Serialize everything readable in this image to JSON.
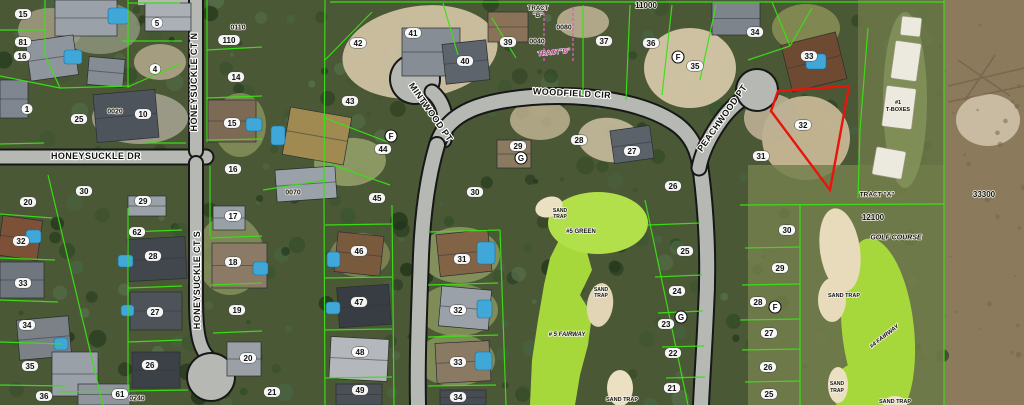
{
  "map": {
    "title": "Aerial parcel map - Woodfield Cir / Honeysuckle Dr subdivision with golf course",
    "colors": {
      "parcel_line": "#3ae114",
      "highlight_parcel": "#e8150d",
      "road_fill": "#b5b8b3",
      "road_casing": "#171717",
      "fairway_green": "#a6d83c",
      "sand_trap": "#ece0c2",
      "tract_b_magenta": "#e05cc0",
      "label_halo": "#ffffff"
    },
    "highlighted_parcel": {
      "lot": "32",
      "outline_color": "#e8150d"
    },
    "streets": [
      {
        "id": "honeysuckle-dr",
        "name": "HONEYSUCKLE DR",
        "x": 96,
        "y": 156,
        "rot": 0
      },
      {
        "id": "honeysuckle-ct-n",
        "name": "HONEYSUCKLE CT N",
        "x": 194,
        "y": 82,
        "rot": -90
      },
      {
        "id": "honeysuckle-ct-s",
        "name": "HONEYSUCKLE CT S",
        "x": 197,
        "y": 280,
        "rot": -90
      },
      {
        "id": "woodfield-cir",
        "name": "WOODFIELD CIR",
        "x": 572,
        "y": 93,
        "rot": 3
      },
      {
        "id": "mintwood-pt",
        "name": "MINTWOOD PT",
        "x": 431,
        "y": 112,
        "rot": 55
      },
      {
        "id": "peachwood-pt",
        "name": "PEACHWOOD PT",
        "x": 722,
        "y": 118,
        "rot": -55
      }
    ],
    "lots": [
      {
        "n": "15",
        "x": 23,
        "y": 14
      },
      {
        "n": "81",
        "x": 23,
        "y": 42
      },
      {
        "n": "16",
        "x": 22,
        "y": 56
      },
      {
        "n": "5",
        "x": 157,
        "y": 23
      },
      {
        "n": "4",
        "x": 155,
        "y": 69
      },
      {
        "n": "14",
        "x": 236,
        "y": 77
      },
      {
        "n": "15",
        "x": 232,
        "y": 123
      },
      {
        "n": "1",
        "x": 27,
        "y": 109
      },
      {
        "n": "25",
        "x": 79,
        "y": 119
      },
      {
        "n": "10",
        "x": 143,
        "y": 114
      },
      {
        "n": "16",
        "x": 233,
        "y": 169
      },
      {
        "n": "30",
        "x": 84,
        "y": 191
      },
      {
        "n": "29",
        "x": 143,
        "y": 201
      },
      {
        "n": "20",
        "x": 28,
        "y": 202
      },
      {
        "n": "32",
        "x": 21,
        "y": 241
      },
      {
        "n": "33",
        "x": 23,
        "y": 283
      },
      {
        "n": "34",
        "x": 27,
        "y": 325
      },
      {
        "n": "35",
        "x": 30,
        "y": 366
      },
      {
        "n": "36",
        "x": 44,
        "y": 396
      },
      {
        "n": "62",
        "x": 137,
        "y": 232
      },
      {
        "n": "28",
        "x": 153,
        "y": 256
      },
      {
        "n": "27",
        "x": 155,
        "y": 312
      },
      {
        "n": "26",
        "x": 150,
        "y": 365
      },
      {
        "n": "17",
        "x": 233,
        "y": 216
      },
      {
        "n": "18",
        "x": 233,
        "y": 262
      },
      {
        "n": "19",
        "x": 237,
        "y": 310
      },
      {
        "n": "20",
        "x": 248,
        "y": 358
      },
      {
        "n": "61",
        "x": 120,
        "y": 394
      },
      {
        "n": "110",
        "x": 229,
        "y": 40
      },
      {
        "n": "42",
        "x": 358,
        "y": 43
      },
      {
        "n": "41",
        "x": 413,
        "y": 33
      },
      {
        "n": "40",
        "x": 465,
        "y": 61
      },
      {
        "n": "39",
        "x": 508,
        "y": 42
      },
      {
        "n": "43",
        "x": 350,
        "y": 101
      },
      {
        "n": "44",
        "x": 383,
        "y": 149
      },
      {
        "n": "45",
        "x": 377,
        "y": 198
      },
      {
        "n": "30",
        "x": 475,
        "y": 192
      },
      {
        "n": "37",
        "x": 604,
        "y": 41
      },
      {
        "n": "36",
        "x": 651,
        "y": 43
      },
      {
        "n": "35",
        "x": 695,
        "y": 66
      },
      {
        "n": "34",
        "x": 755,
        "y": 32
      },
      {
        "n": "33",
        "x": 809,
        "y": 56
      },
      {
        "n": "32",
        "x": 803,
        "y": 125
      },
      {
        "n": "31",
        "x": 761,
        "y": 156
      },
      {
        "n": "29",
        "x": 518,
        "y": 146
      },
      {
        "n": "28",
        "x": 579,
        "y": 140
      },
      {
        "n": "27",
        "x": 632,
        "y": 151
      },
      {
        "n": "26",
        "x": 673,
        "y": 186
      },
      {
        "n": "46",
        "x": 359,
        "y": 251
      },
      {
        "n": "47",
        "x": 359,
        "y": 302
      },
      {
        "n": "48",
        "x": 360,
        "y": 352
      },
      {
        "n": "49",
        "x": 360,
        "y": 390
      },
      {
        "n": "21",
        "x": 272,
        "y": 392
      },
      {
        "n": "31",
        "x": 462,
        "y": 259
      },
      {
        "n": "32",
        "x": 458,
        "y": 310
      },
      {
        "n": "33",
        "x": 458,
        "y": 362
      },
      {
        "n": "34",
        "x": 458,
        "y": 397
      },
      {
        "n": "25",
        "x": 685,
        "y": 251
      },
      {
        "n": "24",
        "x": 677,
        "y": 291
      },
      {
        "n": "23",
        "x": 666,
        "y": 324
      },
      {
        "n": "22",
        "x": 673,
        "y": 353
      },
      {
        "n": "21",
        "x": 672,
        "y": 388
      },
      {
        "n": "30",
        "x": 787,
        "y": 230
      },
      {
        "n": "29",
        "x": 780,
        "y": 268
      },
      {
        "n": "28",
        "x": 758,
        "y": 302
      },
      {
        "n": "27",
        "x": 769,
        "y": 333
      },
      {
        "n": "26",
        "x": 768,
        "y": 367
      },
      {
        "n": "25",
        "x": 769,
        "y": 394
      }
    ],
    "rings": [
      {
        "n": "F",
        "x": 391,
        "y": 136
      },
      {
        "n": "F",
        "x": 678,
        "y": 57
      },
      {
        "n": "G",
        "x": 521,
        "y": 158
      },
      {
        "n": "G",
        "x": 681,
        "y": 317
      },
      {
        "n": "F",
        "x": 775,
        "y": 307
      }
    ],
    "areas": [
      {
        "t": "11000",
        "x": 646,
        "y": 5,
        "s": 8
      },
      {
        "t": "33300",
        "x": 984,
        "y": 194,
        "s": 8
      },
      {
        "t": "12100",
        "x": 873,
        "y": 217,
        "s": 8
      },
      {
        "t": "GOLF COURSE",
        "x": 896,
        "y": 237,
        "s": 7,
        "i": 1
      },
      {
        "t": "TRACT",
        "x": 538,
        "y": 8,
        "s": 6
      },
      {
        "t": "\"B\"",
        "x": 538,
        "y": 15,
        "s": 6
      },
      {
        "t": "0080",
        "x": 564,
        "y": 27,
        "s": 7
      },
      {
        "t": "0040",
        "x": 537,
        "y": 41,
        "s": 7
      },
      {
        "t": "TRACT \"A\"",
        "x": 877,
        "y": 194,
        "s": 6.5
      },
      {
        "t": "0110",
        "x": 238,
        "y": 27,
        "s": 7
      },
      {
        "t": "0020",
        "x": 115,
        "y": 111,
        "s": 7
      },
      {
        "t": "0070",
        "x": 293,
        "y": 192,
        "s": 7
      },
      {
        "t": "0240",
        "x": 137,
        "y": 398,
        "s": 7
      },
      {
        "t": "#1",
        "x": 898,
        "y": 102,
        "s": 5.5
      },
      {
        "t": "T-BOXES",
        "x": 898,
        "y": 109,
        "s": 5.5
      },
      {
        "t": "SAND",
        "x": 560,
        "y": 210,
        "s": 5
      },
      {
        "t": "TRAP",
        "x": 560,
        "y": 216,
        "s": 5
      },
      {
        "t": "#5 GREEN",
        "x": 581,
        "y": 231,
        "s": 6
      },
      {
        "t": "SAND",
        "x": 601,
        "y": 289,
        "s": 5
      },
      {
        "t": "TRAP",
        "x": 601,
        "y": 295,
        "s": 5
      },
      {
        "t": "# 5 FAIRWAY",
        "x": 567,
        "y": 334,
        "s": 6,
        "i": 1
      },
      {
        "t": "SAND TRAP",
        "x": 622,
        "y": 399,
        "s": 5.5
      },
      {
        "t": "SAND TRAP",
        "x": 844,
        "y": 295,
        "s": 5.5
      },
      {
        "t": "#4 FAIRWAY",
        "x": 884,
        "y": 336,
        "s": 6,
        "i": 1,
        "rot": -38
      },
      {
        "t": "SAND",
        "x": 837,
        "y": 383,
        "s": 5
      },
      {
        "t": "TRAP",
        "x": 837,
        "y": 390,
        "s": 5
      },
      {
        "t": "SAND TRAP",
        "x": 895,
        "y": 401,
        "s": 5.5
      }
    ],
    "magenta_labels": [
      {
        "t": "TRACT\"B\"",
        "x": 554,
        "y": 52,
        "rot": -6
      }
    ]
  }
}
